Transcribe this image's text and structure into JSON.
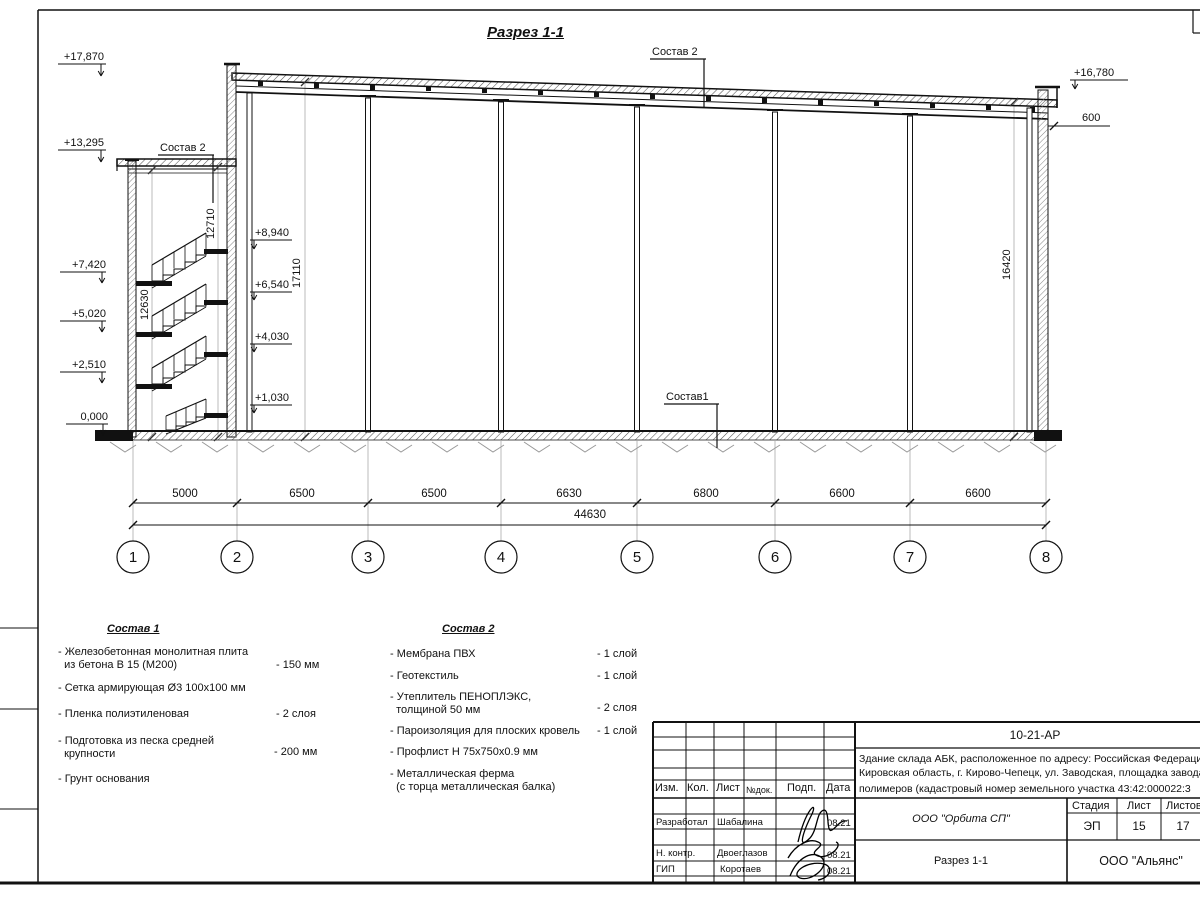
{
  "title": "Разрез 1-1",
  "callouts": {
    "sostav2_left": "Состав 2",
    "sostav2_top": "Состав 2",
    "sostav1": "Состав1"
  },
  "elevations": {
    "left": [
      "+17,870",
      "+13,295",
      "+7,420",
      "+5,020",
      "+2,510",
      "0,000"
    ],
    "inner": [
      "+8,940",
      "+6,540",
      "+4,030",
      "+1,030"
    ],
    "right": "+16,780"
  },
  "dims": {
    "axis": [
      "5000",
      "6500",
      "6500",
      "6630",
      "6800",
      "6600",
      "6600"
    ],
    "total": "44630",
    "stair_left": "12630",
    "stair_right": "12710",
    "hall_left": "17110",
    "hall_right": "16420",
    "parapet": "600"
  },
  "axes": [
    "1",
    "2",
    "3",
    "4",
    "5",
    "6",
    "7",
    "8"
  ],
  "legend1": {
    "title": "Состав 1",
    "items": [
      {
        "text": "- Железобетонная  монолитная плита\n  из бетона В 15 (М200)",
        "value": "- 150 мм"
      },
      {
        "text": "- Сетка армирующая Ø3 100х100 мм"
      },
      {
        "text": "- Пленка полиэтиленовая",
        "value": "-  2 слоя"
      },
      {
        "text": "- Подготовка из песка средней\n  крупности",
        "value": "- 200 мм"
      },
      {
        "text": "- Грунт основания"
      }
    ]
  },
  "legend2": {
    "title": "Состав 2",
    "items": [
      {
        "text": "- Мембрана ПВХ",
        "value": "- 1 слой"
      },
      {
        "text": "- Геотекстиль",
        "value": "- 1 слой"
      },
      {
        "text": "- Утеплитель ПЕНОПЛЭКС,\n  толщиной 50 мм",
        "value": "- 2 слоя"
      },
      {
        "text": "- Пароизоляция для плоских кровель",
        "value": "- 1 слой"
      },
      {
        "text": "- Профлист Н 75х750х0.9 мм"
      },
      {
        "text": "- Металлическая ферма\n  (с торца металлическая балка)"
      }
    ]
  },
  "titleblock": {
    "doc_code": "10-21-АР",
    "object_lines": [
      "Здание склада АБК, расположенное по адресу: Российская Федерация,",
      "Кировская область, г. Кирово-Чепецк, ул. Заводская, площадка завода",
      "полимеров (кадастровый номер земельного участка 43:42:000022:3"
    ],
    "header": {
      "izm": "Изм.",
      "kol": "Кол.",
      "list": "Лист",
      "ndok": "№док.",
      "podp": "Подп.",
      "data": "Дата"
    },
    "rows": [
      {
        "role": "Разработал",
        "name": "Шабалина",
        "date": "08.21"
      },
      {
        "role": "Н. контр.",
        "name": "Двоеглазов",
        "date": "08.21"
      },
      {
        "role": "ГИП",
        "name": "Коротаев",
        "date": "08.21"
      }
    ],
    "designer_org": "ООО \"Орбита СП\"",
    "stage_label": "Стадия",
    "sheet_label": "Лист",
    "sheets_label": "Листов",
    "stage": "ЭП",
    "sheet": "15",
    "sheets": "17",
    "sheet_title": "Разрез 1-1",
    "contractor_org": "ООО \"Альянс\""
  }
}
